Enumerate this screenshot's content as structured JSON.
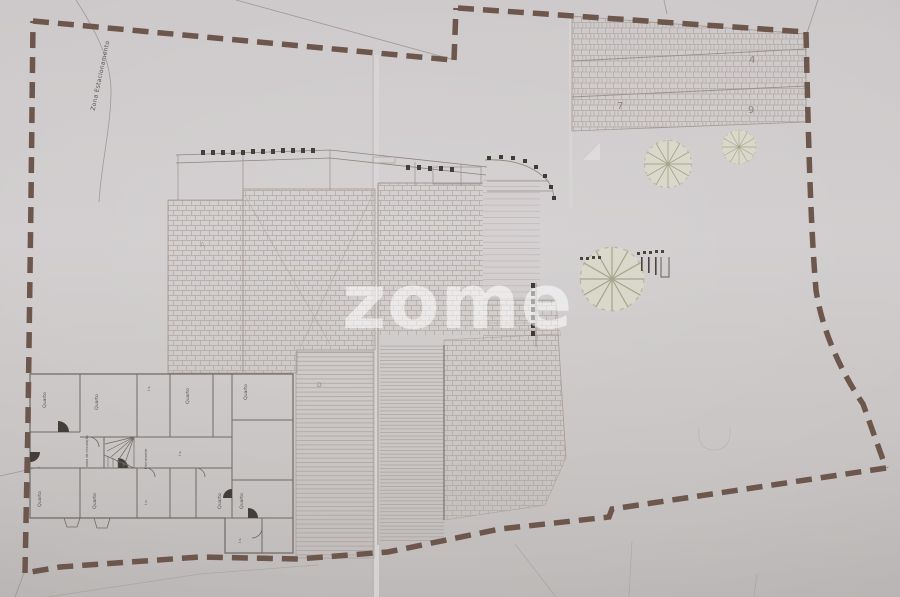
{
  "photo": {
    "description": "Photograph of a hand-drawn architectural site plan with dashed property boundary, roof hatching, trees and a bedroom floor plan",
    "watermark_text": "zome"
  },
  "watermark": {
    "text": "zome",
    "color": "rgba(255,255,255,0.55)"
  },
  "colors": {
    "paper": "#cecacb",
    "boundary_dash": "#6d564c",
    "draw_ink": "#6f6a66",
    "hatch": "#b2a7a1",
    "tree_fill": "#dcdac9",
    "tree_stroke": "#9c9c82"
  },
  "site": {
    "parking_zone_label": "Zona Estacionamento",
    "deck_label": "D",
    "roof_mark": "A",
    "plot_numbers": [
      {
        "value": "4"
      },
      {
        "value": "7"
      },
      {
        "value": "9"
      }
    ]
  },
  "floorplan": {
    "rooms": [
      {
        "label": "Quarto"
      },
      {
        "label": "Quarto"
      },
      {
        "label": "I.s."
      },
      {
        "label": "Quarto"
      },
      {
        "label": "Quarto"
      },
      {
        "label": "zona de circulação"
      },
      {
        "label": "Kitchenette"
      },
      {
        "label": "I.s."
      },
      {
        "label": "Quarto"
      },
      {
        "label": "Quarto"
      },
      {
        "label": "I.s."
      },
      {
        "label": "Quarto"
      },
      {
        "label": "Quarto"
      },
      {
        "label": "I.s."
      }
    ]
  }
}
